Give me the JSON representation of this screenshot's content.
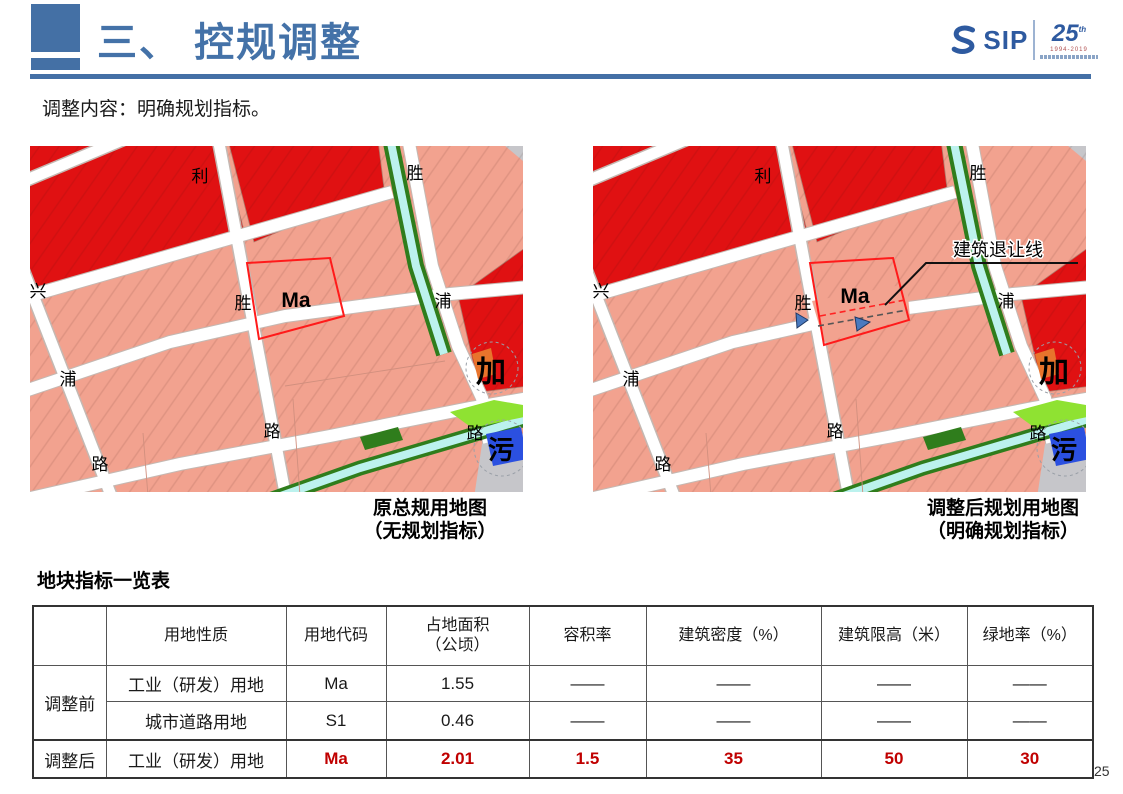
{
  "header": {
    "title": "三、 控规调整",
    "logo": {
      "sip": "SIP",
      "anniversary": "25",
      "anniversary_suffix": "th",
      "years": "1994-2019"
    }
  },
  "subtitle": "调整内容：明确规划指标。",
  "maps": {
    "left": {
      "caption_line1": "原总规用地图",
      "caption_line2": "（无规划指标）",
      "labels": {
        "li": "利",
        "sheng_top": "胜",
        "xing": "兴",
        "sheng_mid": "胜",
        "ma": "Ma",
        "pu_right": "浦",
        "pu_left": "浦",
        "jia": "加",
        "lu_center": "路",
        "lu_right": "路",
        "wu": "污",
        "lu_left": "路"
      }
    },
    "right": {
      "caption_line1": "调整后规划用地图",
      "caption_line2": "（明确规划指标）",
      "setback_label": "建筑退让线",
      "labels": {
        "li": "利",
        "sheng_top": "胜",
        "xing": "兴",
        "sheng_mid": "胜",
        "ma": "Ma",
        "pu_right": "浦",
        "pu_left": "浦",
        "jia": "加",
        "lu_center": "路",
        "lu_right": "路",
        "wu": "污",
        "lu_left": "路"
      }
    }
  },
  "table": {
    "title": "地块指标一览表",
    "headers": [
      "",
      "用地性质",
      "用地代码",
      "占地面积",
      "容积率",
      "建筑密度（%）",
      "建筑限高（米）",
      "绿地率（%）"
    ],
    "area_header_unit": "（公顷）",
    "rows": [
      {
        "group": "调整前",
        "nature": "工业（研发）用地",
        "code": "Ma",
        "area": "1.55",
        "far": "——",
        "density": "——",
        "height": "——",
        "green": "——"
      },
      {
        "group": "",
        "nature": "城市道路用地",
        "code": "S1",
        "area": "0.46",
        "far": "——",
        "density": "——",
        "height": "——",
        "green": "——"
      },
      {
        "group": "调整后",
        "nature": "工业（研发）用地",
        "code": "Ma",
        "area": "2.01",
        "far": "1.5",
        "density": "35",
        "height": "50",
        "green": "30"
      }
    ]
  },
  "page_number": "25",
  "colors": {
    "accent_blue": "#4472a8",
    "logo_blue": "#2e5aa0",
    "parcel_red": "#e01112",
    "parcel_salmon": "#f2a28f",
    "highlight_rect_red": "#ff1a1a",
    "table_value_red": "#c00000",
    "canal_green": "#2f7d1c",
    "canal_cyan": "#bcf2ee",
    "bright_green": "#8fe232",
    "facility_blue": "#2b50e0",
    "facility_orange": "#e8742c",
    "gray_parcel": "#c6c6ca"
  }
}
